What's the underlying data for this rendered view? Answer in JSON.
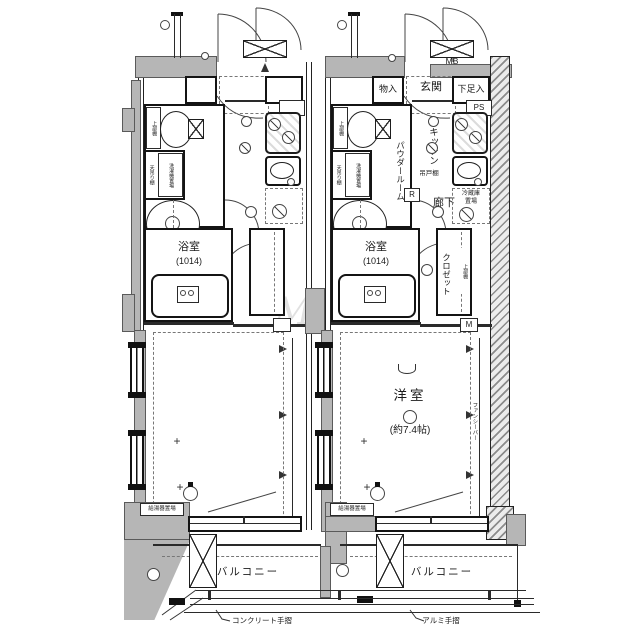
{
  "watermark": "MR",
  "left_unit": {
    "bath": "浴室",
    "bath_size": "(1014)",
    "toilet_shelf": "上部棚",
    "ceiling_shelf": "天吊り棚",
    "washer": "洗濯機置場",
    "water_heater": "給湯器置場",
    "balcony": "バルコニー",
    "handrail": "コンクリート手摺",
    "plus_mark": "+"
  },
  "right_unit": {
    "storage": "物入",
    "entrance": "玄関",
    "shoe_box": "下足入",
    "meter_box": "MB",
    "pipe_space": "PS",
    "toilet_shelf": "上部棚",
    "ceiling_shelf": "天吊り棚",
    "washer": "洗濯機置場",
    "powder_room": "パウダールーム",
    "kitchen": "キッチン",
    "hanging_cupboard": "吊戸棚",
    "hall": "廊下",
    "r_mark": "R",
    "fridge_top": "冷蔵庫",
    "fridge_bottom": "置場",
    "closet": "クロゼット",
    "upper_shelf": "上部棚",
    "m_mark": "M",
    "bath": "浴室",
    "bath_size": "(1014)",
    "room": "洋室",
    "room_size": "(約7.4帖)",
    "fancy_bar": "ファンシーバー",
    "water_heater": "給湯器置場",
    "balcony": "バルコニー",
    "handrail": "アルミ手摺",
    "plus_mark": "+"
  }
}
